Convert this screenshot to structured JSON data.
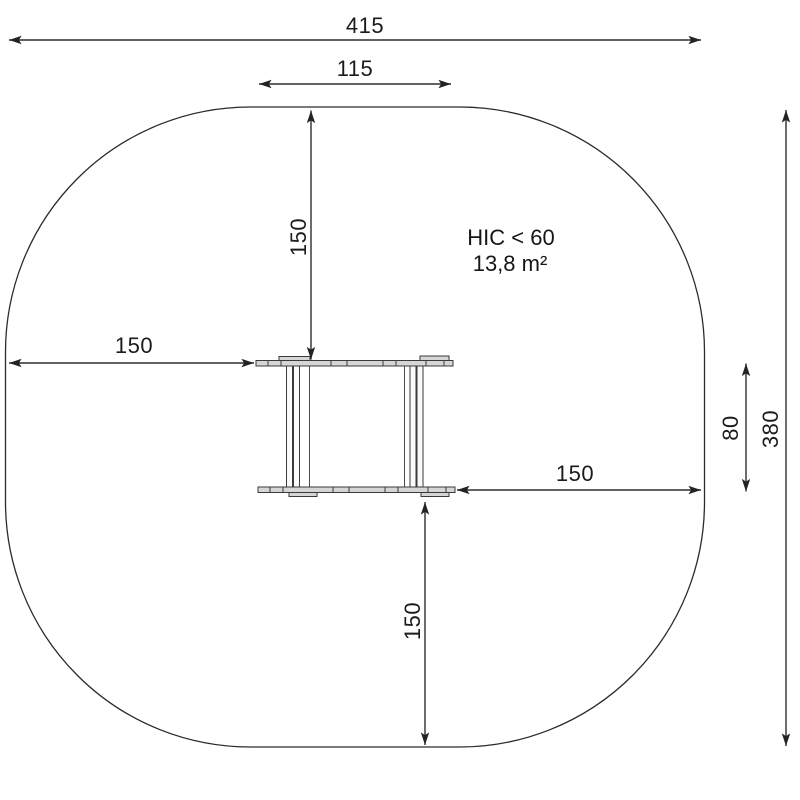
{
  "diagram": {
    "type": "playground-equipment-safety-zone-plan",
    "dimensions": {
      "total_width": "415",
      "platform_width": "115",
      "left_clearance": "150",
      "top_clearance": "150",
      "right_clearance": "150",
      "bottom_clearance": "150",
      "equipment_depth": "80",
      "total_height": "380"
    },
    "annotations": {
      "hic": "HIC < 60",
      "area": "13,8 m²"
    },
    "colors": {
      "line": "#2d2d2d",
      "text": "#1b1b1b",
      "plank_fill": "#d6d6d6",
      "background": "#ffffff"
    }
  }
}
